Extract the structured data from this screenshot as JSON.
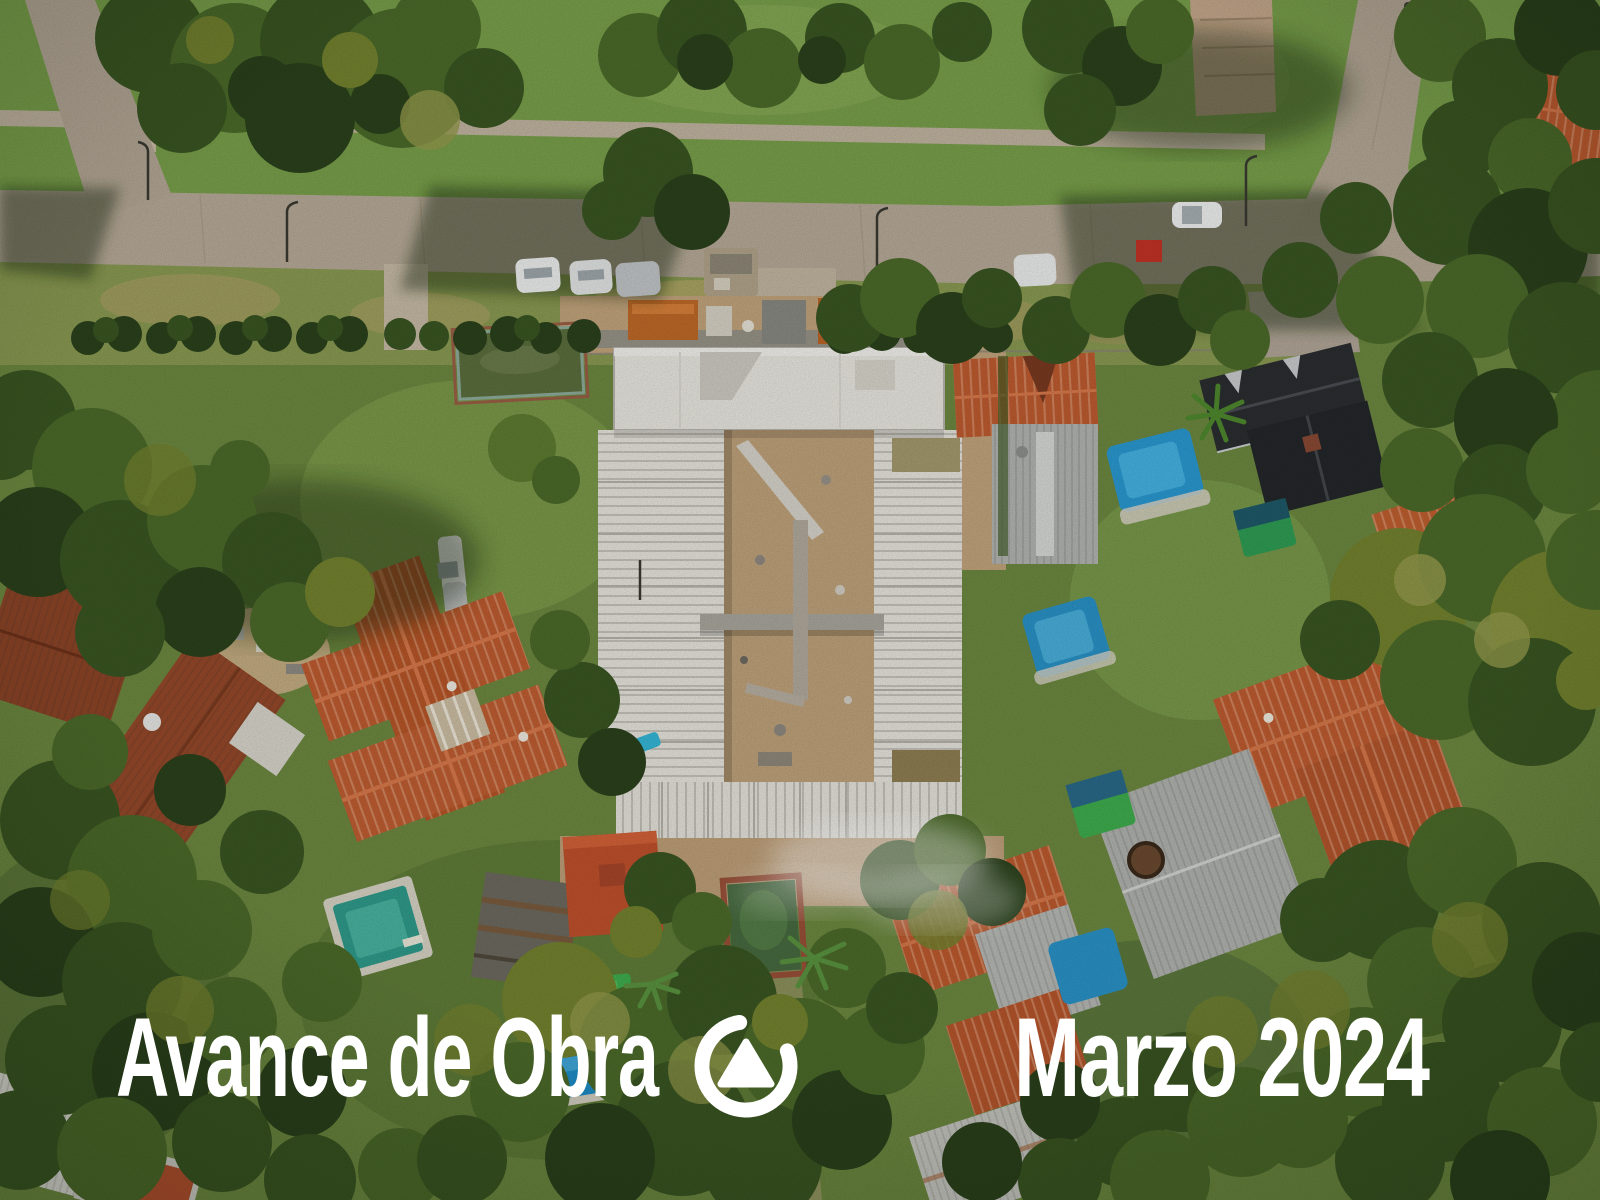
{
  "photo": {
    "kind": "aerial-drone-photograph",
    "subject": "top-down view of a residential block with an apartment building under construction",
    "features": [
      "building-under-construction",
      "streets",
      "sidewalks",
      "parked-cars",
      "tile-roof-houses",
      "swimming-pools",
      "gardens",
      "large-trees",
      "smoke-wisp"
    ]
  },
  "overlay": {
    "title_left": "Avance de Obra",
    "title_right": "Marzo 2024",
    "logo": "circle-triangle-logo",
    "text_color": "#ffffff"
  },
  "palette": {
    "grass": "#7ba04c",
    "tree_dark": "#2b421c",
    "road": "#b9ac9a",
    "dirt": "#c2a57e",
    "roof_orange": "#bf5c30",
    "roof_rust": "#8d4527",
    "roof_dark": "#2b2e30",
    "concrete_white": "#eae8e1",
    "pool_blue": "#2a9ad2",
    "pool_teal": "#2f9c8c",
    "pool_green": "#3fae4e"
  }
}
